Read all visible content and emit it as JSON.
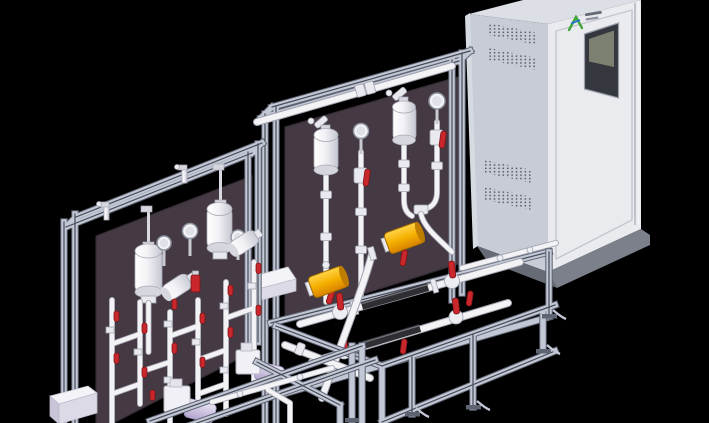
{
  "scene": {
    "kind": "3d-cad-render",
    "subject": "two skid-mounted chemical dosing units with piping and a control cabinet",
    "background": "black"
  },
  "colors": {
    "bg": "#000000",
    "panel": "#453a43",
    "panelEdge": "#332b33",
    "frameLight": "#c3c8d6",
    "frameEdge": "#5f6472",
    "frameGroove": "#474b57",
    "pipe": "#f3f3f6",
    "pipeEdge": "#9ea0ac",
    "blackPipe": "#2e2e33",
    "red": "#c9272b",
    "redDark": "#7c1416",
    "yellow": "#f5b000",
    "yellowDeep": "#d98200",
    "yellowCap": "#a06a00",
    "cabSide": "#c7ccd6",
    "cabFront": "#e9ebef",
    "cabTop": "#dce0e6",
    "cabBase": "#7b808a",
    "cabBaseSide": "#666b75",
    "vent": "#565b66",
    "hmiFrame": "#34373e",
    "hmiScreen": "#7b8070",
    "logoGreen": "#3fa535",
    "logoBlue": "#2277cc",
    "pump": "#f1f0f6",
    "pumpLav": "#cbc0de"
  },
  "cabinet": {
    "name": "control-cabinet",
    "logo_mark": "AX",
    "logo_caption_lines": 2,
    "vent_blocks": 4,
    "hmi_screen": true
  },
  "skid_front": {
    "name": "dosing-skid-front-left",
    "dome_dampeners": 2,
    "pressure_gauges": 3,
    "angled_cylinders": 2,
    "red_valve_caps": 13,
    "pumps": 2
  },
  "skid_center": {
    "name": "dosing-skid-center",
    "dome_dampeners": 2,
    "pressure_gauges": 2,
    "yellow_dampeners": 2,
    "manifold_lines": 2,
    "red_valve_levers": 8
  }
}
